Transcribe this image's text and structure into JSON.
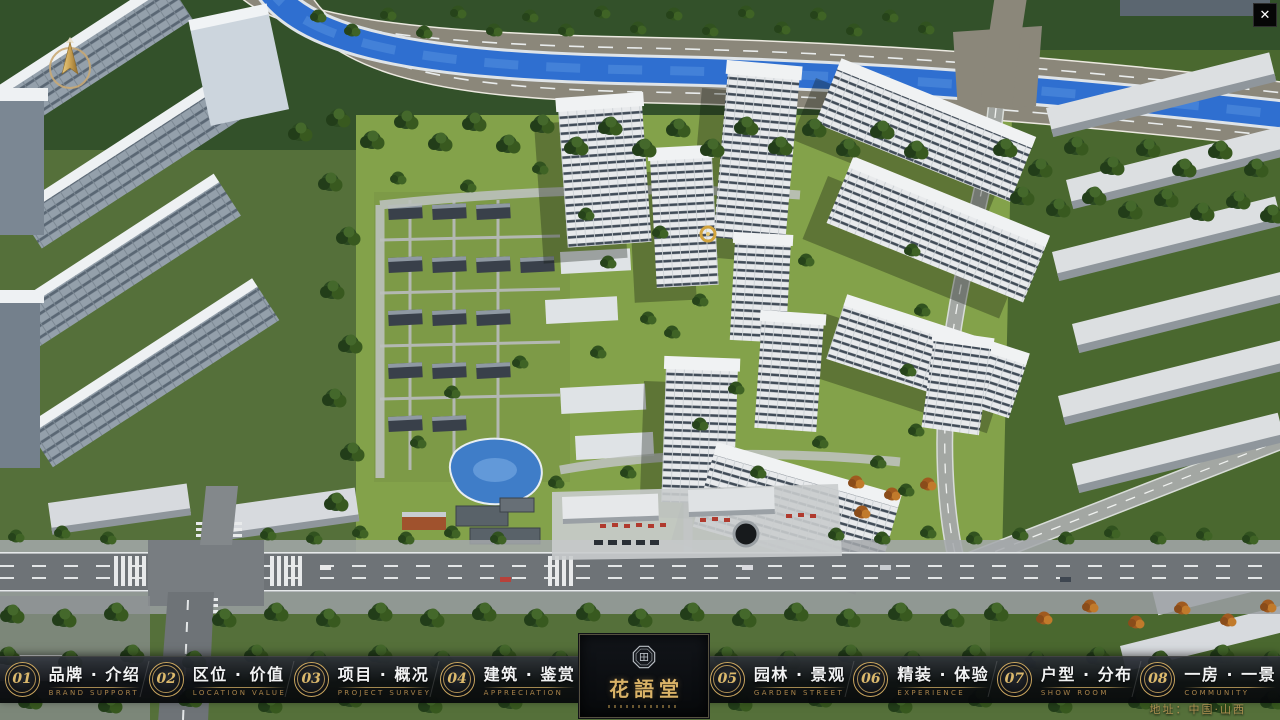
{
  "window": {
    "close_glyph": "✕"
  },
  "nav": {
    "items": [
      {
        "num": "01",
        "zh": "品牌 · 介绍",
        "en": "BRAND SUPPORT"
      },
      {
        "num": "02",
        "zh": "区位 · 价值",
        "en": "LOCATION VALUE"
      },
      {
        "num": "03",
        "zh": "项目 · 概况",
        "en": "PROJECT SURVEY"
      },
      {
        "num": "04",
        "zh": "建筑 · 鉴赏",
        "en": "APPRECIATION"
      },
      {
        "num": "05",
        "zh": "园林 · 景观",
        "en": "GARDEN STREET"
      },
      {
        "num": "06",
        "zh": "精装 · 体验",
        "en": "EXPERIENCE"
      },
      {
        "num": "07",
        "zh": "户型 · 分布",
        "en": "SHOW ROOM"
      },
      {
        "num": "08",
        "zh": "一房 · 一景",
        "en": "COMMUNITY"
      }
    ]
  },
  "logo": {
    "name": "花語堂"
  },
  "footer": {
    "address": "地址：中国·山西"
  },
  "palette": {
    "gold": "#c9a55e",
    "grass": "#83a24a",
    "water": "#2f6fd0",
    "road": "#6e7377",
    "bar_bg": "#0c0e12"
  }
}
